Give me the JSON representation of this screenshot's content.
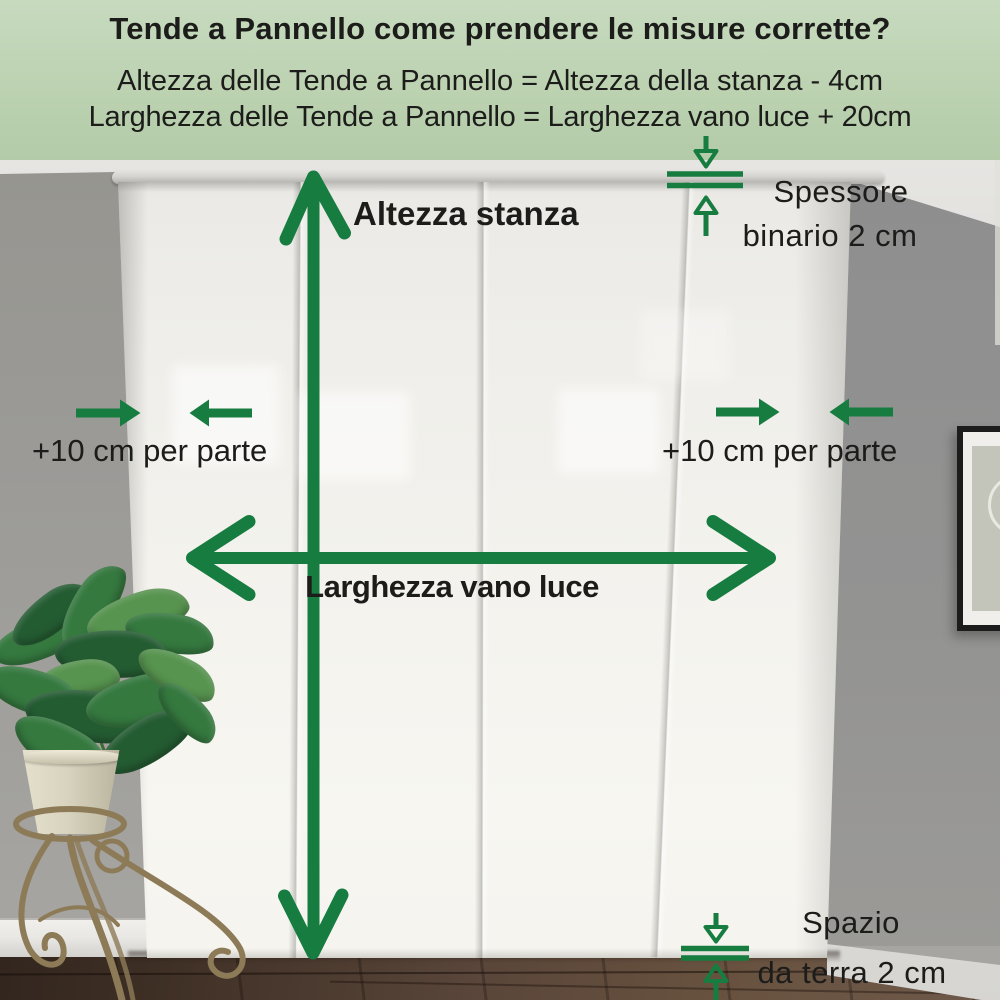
{
  "header": {
    "title": "Tende a Pannello come prendere le misure corrette?",
    "formula_height": "Altezza delle Tende a Pannello = Altezza della stanza - 4cm",
    "formula_width": "Larghezza delle Tende a Pannello = Larghezza vano luce + 20cm"
  },
  "annotations": {
    "room_height_label": "Altezza stanza",
    "window_width_label": "Larghezza vano luce",
    "side_margin_left_label": "+10 cm per parte",
    "side_margin_right_label": "+10 cm per parte",
    "rail_thickness_label": {
      "line1": "Spessore",
      "line2": "binario 2 cm"
    },
    "floor_gap_label": {
      "line1": "Spazio",
      "line2": "da terra 2 cm"
    }
  },
  "scene": {
    "curtain_panels": 4
  },
  "palette": {
    "header_bg": "#bcd2b1",
    "arrow_green": "#177c40",
    "text_black": "#1c1c1a",
    "wall_left": "#9b9a97",
    "wall_right": "#8e8e8f",
    "curtain": "#f3f2ed",
    "rail": "#d3d2cf",
    "floor_mid": "#5a463a",
    "floor_light": "#6e584a",
    "baseboard": "#e9e8e4",
    "pot": "#d9d4bf",
    "stand_brass": "#8d7b57",
    "leaf_dark": "#245c32",
    "leaf_mid": "#35793f",
    "leaf_light": "#57944f",
    "frame_black": "#1c1c1c",
    "frame_mat": "#f0efec",
    "frame_art": "#c3c5bb"
  }
}
